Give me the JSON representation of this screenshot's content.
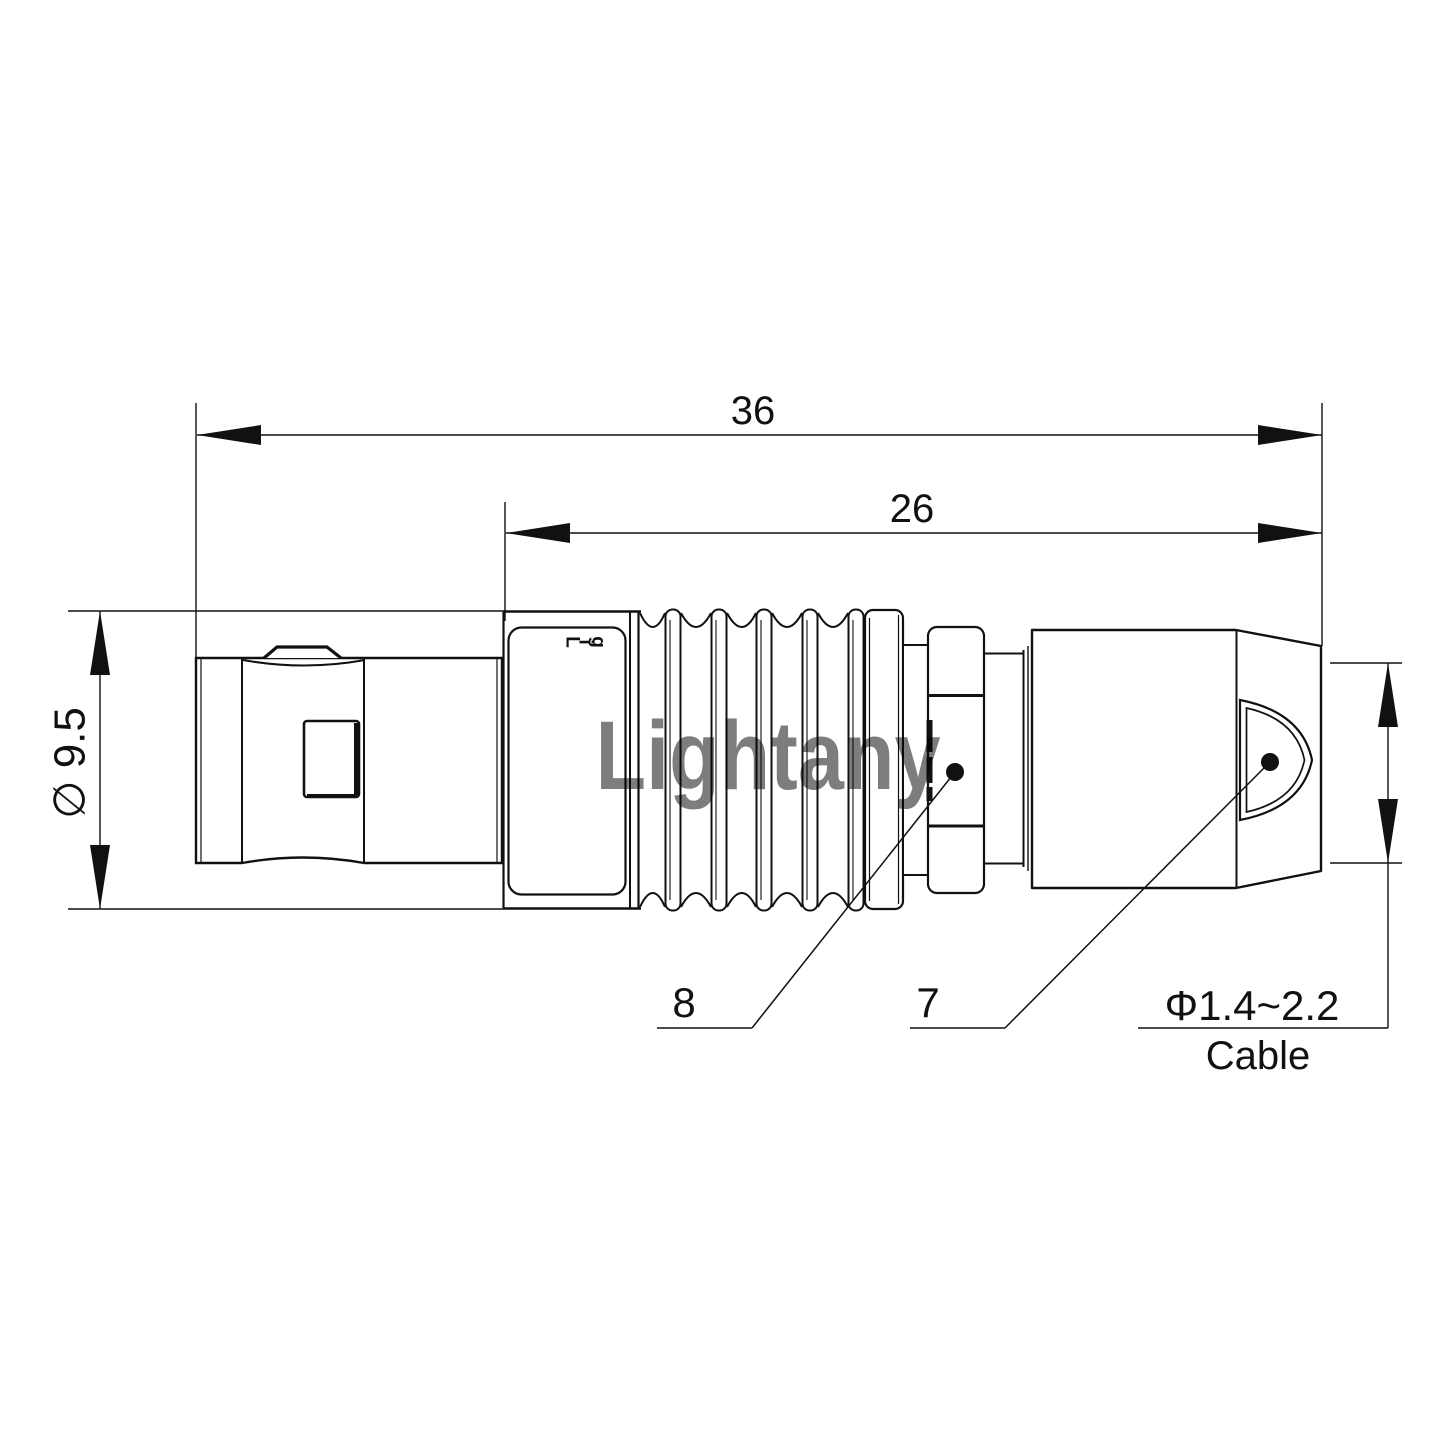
{
  "colors": {
    "line": "#111111",
    "watermark": "#efaeb5"
  },
  "watermark": {
    "text": "Lightany"
  },
  "brand_letters": [
    "L",
    "i",
    "g"
  ],
  "dimensions": {
    "overall_length": "36",
    "rear_section_length": "26",
    "shell_diameter": "∅ 9.5",
    "cable_diameter": "Φ1.4~2.2",
    "cable_word": "Cable"
  },
  "part_labels": {
    "part_8": "8",
    "part_7": "7"
  }
}
